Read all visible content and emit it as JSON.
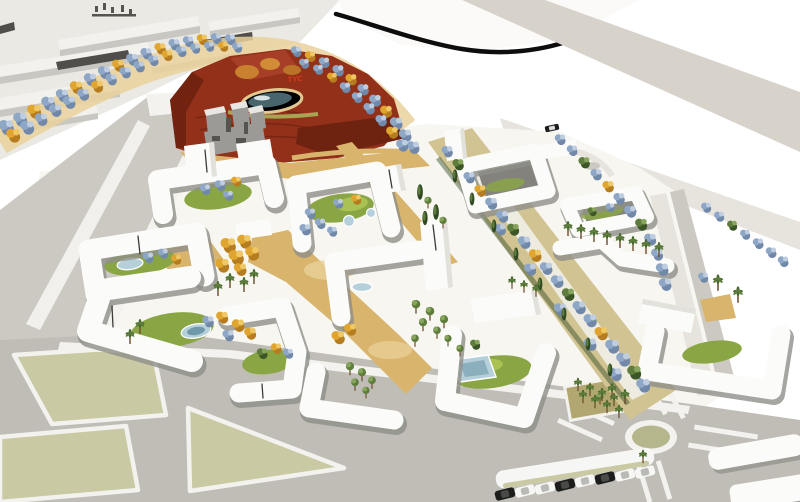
{
  "scene": {
    "park_label": "TYC"
  },
  "colors": {
    "bg": "#ffffff",
    "ind_ground": "#ebe9e4",
    "ind_top": "#f2f1ed",
    "ind_side": "#c9c7c2",
    "ind_roof": "#4f4e4a",
    "road": "#bfbdb6",
    "road_light": "#ccc9c2",
    "sidewalk": "#f3f2ee",
    "median": "#f1f0ec",
    "parcel": "#c9c9a3",
    "highway": "#d7d3ca",
    "strip_light": "#e6e4dd",
    "mound": "#fbfaf8",
    "edge_black": "#0d0d0d",
    "park_red": "#93301a",
    "park_red_dark": "#6e2210",
    "park_red_light": "#ad422a",
    "orange_grove": "#c9812f",
    "pond": "#b5d0da",
    "pond_deep": "#6f99a8",
    "pond_rim": "#e2c78e",
    "glint": "#f3fafc",
    "bank_green": "#a8b35b",
    "sand": "#d9b46c",
    "sand_light": "#e9d19b",
    "site": "#f7f6f1",
    "grass": "#8aa644",
    "grass_light": "#a9c253",
    "bld_top": "#fbfbf9",
    "bld_side": "#e2e1dc",
    "bld_shadow": "#8f8e89",
    "bld_inner": "#84827d",
    "seam": "#3c3b39",
    "tree_blue": "#8ea7c7",
    "tree_blue_light": "#bfcde1",
    "tree_blue_dark": "#7188a9",
    "tree_yellow": "#dfa52f",
    "tree_yellow_light": "#f0c765",
    "tree_yellow_dark": "#b57d1f",
    "tree_green": "#5e7d3c",
    "tree_green_light": "#86a45c",
    "tree_green_dark": "#3c5526",
    "cypress": "#2f4a23",
    "palm": "#47682c",
    "trunk": "#6d4c2b",
    "plaza_tan": "#b3a771",
    "olive_island": "#b6b68d",
    "car_dark": "#1d1d1d",
    "car_light": "#f6f6f4",
    "pavilion_top": "#e9e7e3",
    "pavilion_side": "#9c9a96",
    "pavilion_dark": "#55544f",
    "label_red": "#d03a1c"
  }
}
